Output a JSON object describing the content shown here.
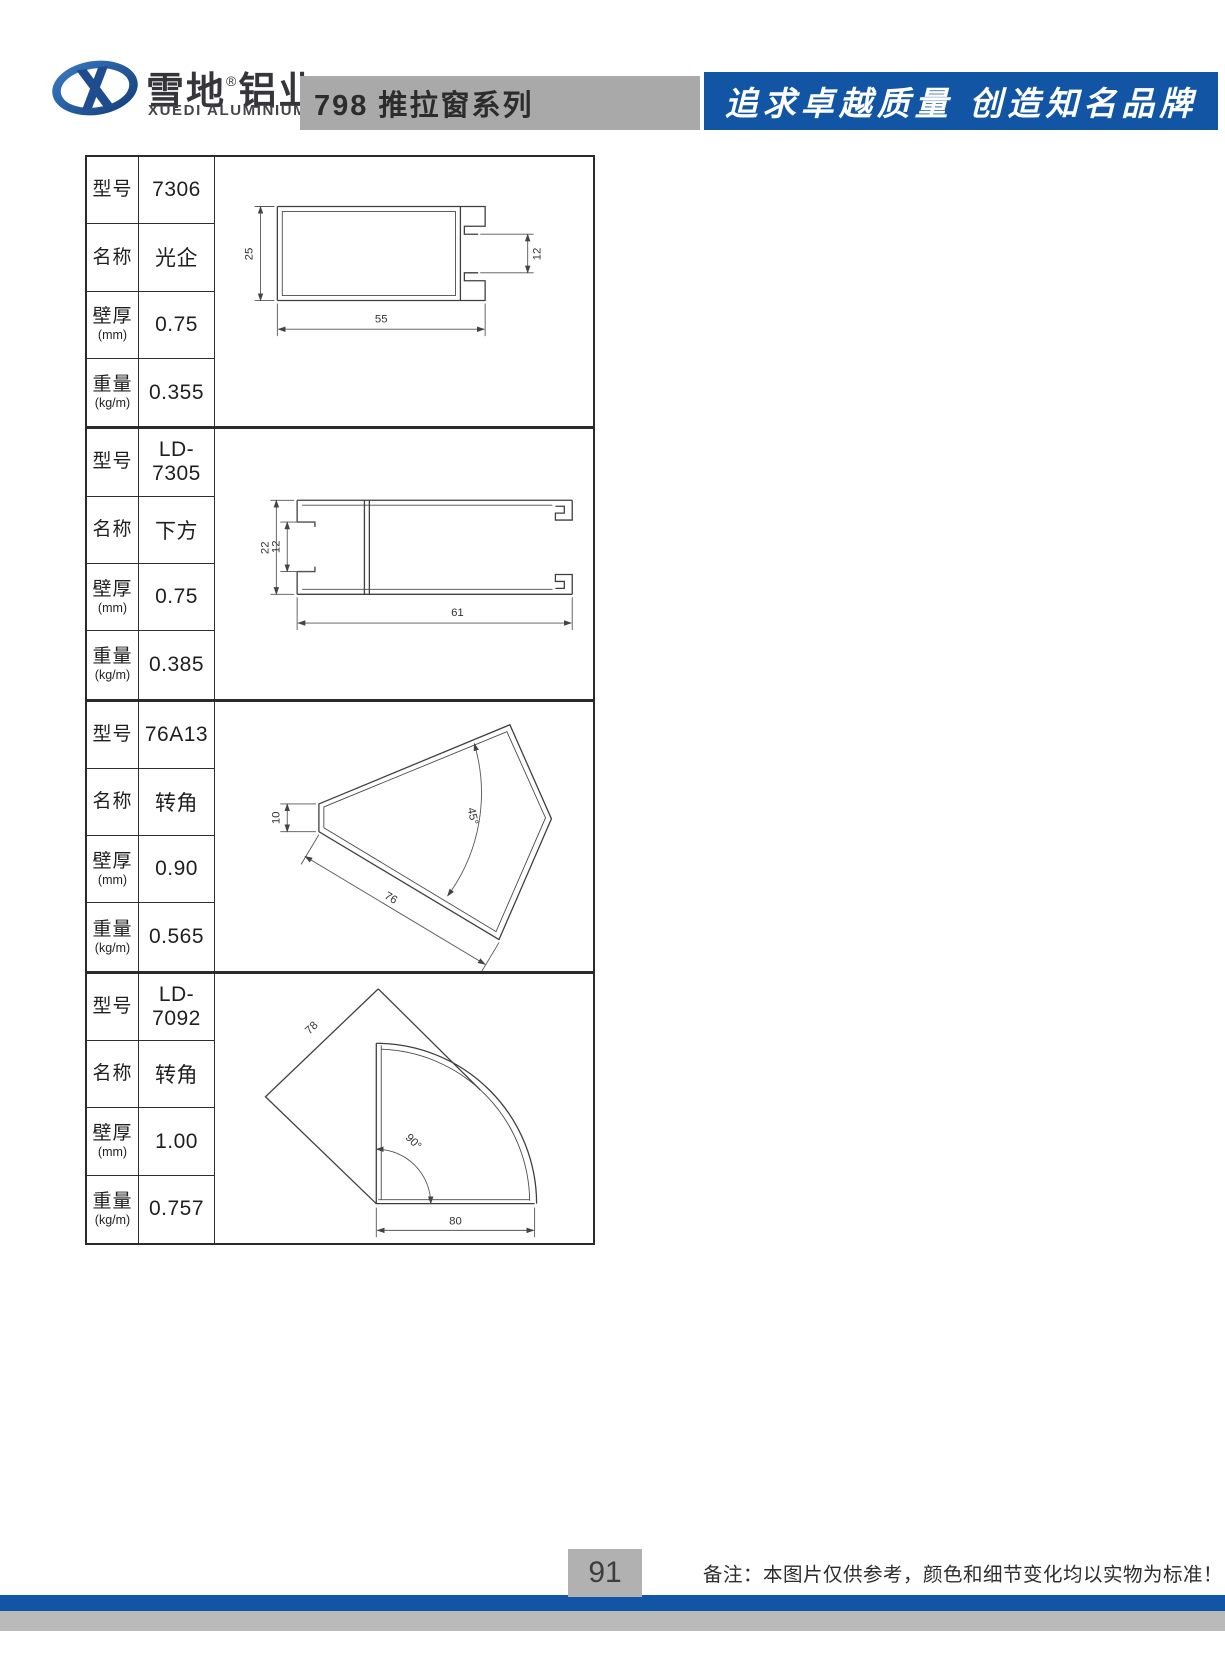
{
  "header": {
    "brand_cn_a": "雪地",
    "reg": "®",
    "brand_cn_b": "铝业",
    "brand_en": "XUEDI ALUMINIUM",
    "series_title": "798 推拉窗系列",
    "slogan": "追求卓越质量 创造知名品牌"
  },
  "labels": {
    "model": "型号",
    "name": "名称",
    "thickness": "壁厚",
    "thickness_unit": "(mm)",
    "weight": "重量",
    "weight_unit": "(kg/m)"
  },
  "sections": [
    {
      "model": "7306",
      "name": "光企",
      "thickness": "0.75",
      "weight": "0.355",
      "dims": {
        "d1": "25",
        "d2": "12",
        "d3": "55"
      }
    },
    {
      "model": "LD-7305",
      "name": "下方",
      "thickness": "0.75",
      "weight": "0.385",
      "dims": {
        "d1": "22",
        "d2": "12",
        "d3": "61"
      }
    },
    {
      "model": "76A13",
      "name": "转角",
      "thickness": "0.90",
      "weight": "0.565",
      "dims": {
        "d1": "10",
        "d2": "45°",
        "d3": "76"
      }
    },
    {
      "model": "LD-7092",
      "name": "转角",
      "thickness": "1.00",
      "weight": "0.757",
      "dims": {
        "d1": "78",
        "d2": "90°",
        "d3": "80"
      }
    }
  ],
  "footer": {
    "page_number": "91",
    "note": "备注：本图片仅供参考，颜色和细节变化均以实物为标准！"
  },
  "colors": {
    "banner_blue": "#1155a4",
    "titlebar_gray": "#a9a9a9",
    "pagenum_gray": "#b1b1b1",
    "footer_gray": "#bababa",
    "logo_blue_dark": "#123c78",
    "logo_blue_light": "#3b7cc4"
  }
}
